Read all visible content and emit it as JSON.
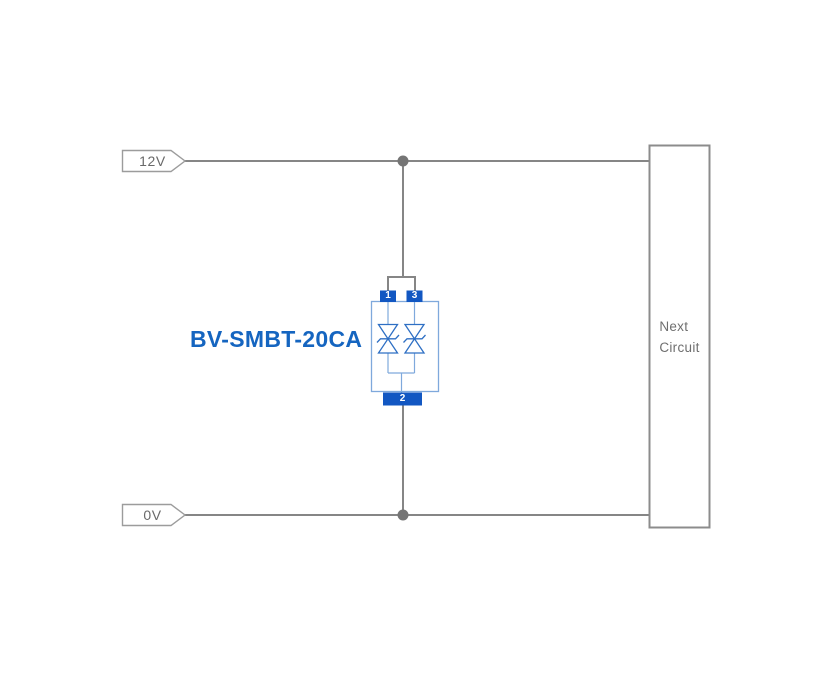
{
  "diagram": {
    "type": "circuit-schematic",
    "nets": {
      "v12": "12V",
      "v0": "0V"
    },
    "component": {
      "label": "BV-SMBT-20CA",
      "kind": "bidirectional-tvs-diode-array",
      "pin1": "1",
      "pin3": "3",
      "pin2": "2"
    },
    "next_circuit": {
      "line1": "Next",
      "line2": "Circuit"
    },
    "colors": {
      "wire": "#868686",
      "junction_dot": "#757575",
      "net_tag_border": "#9c9c9c",
      "net_tag_text": "#696969",
      "next_circuit_border": "#8c8c8c",
      "next_circuit_text": "#6f6f6f",
      "component_label_text": "#1565c0",
      "component_body_outline": "#7fa9dc",
      "tvs_symbol_stroke": "#2e6fc4",
      "pin_pad_fill": "#1257c2",
      "pin_number_text": "#ffffff",
      "background": "#ffffff"
    }
  }
}
